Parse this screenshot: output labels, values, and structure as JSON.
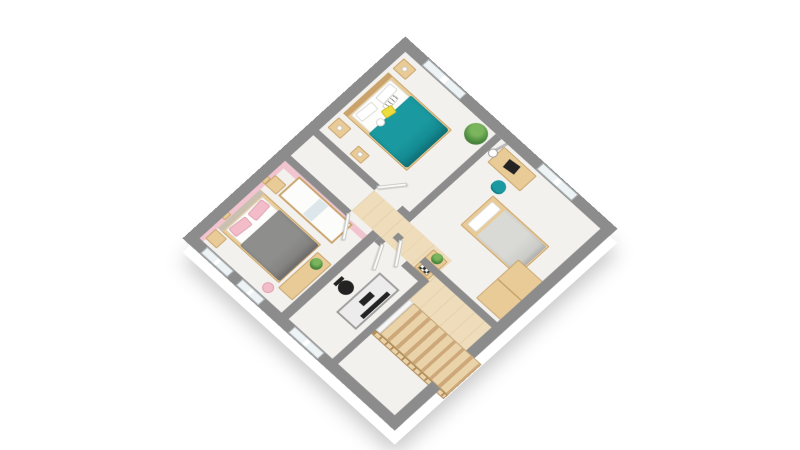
{
  "scene": {
    "kind": "3d-floorplan-render",
    "view": "isometric-top",
    "background": "#ffffff",
    "visible_text": "none"
  },
  "palette": {
    "wall-top": "#8c8c8c",
    "wall-face": "#ffffff",
    "floor": "#f3f1ed",
    "floor-wood": "#eedcba",
    "stair-wood": "#ead3a9",
    "stair-edge": "#cda87a",
    "wood": "#e8cb97",
    "wood-dark": "#c9a36b",
    "teal": "#1a9aa0",
    "teal-dark": "#11828a",
    "yellow": "#ecdc3e",
    "pink-wall": "#f2c4cf",
    "pink": "#f2bcc9",
    "gray-duvet": "#8e8e8c",
    "gray-light": "#d9d9d6",
    "black": "#232323",
    "metal": "#9e9e9e",
    "green": "#4e8c41",
    "green-light": "#7ab45c",
    "mirror": "#dde6ea",
    "door": "#fbfbfa"
  },
  "rooms": [
    {
      "name": "bedroom-top",
      "furniture": [
        "double-bed-teal-duvet",
        "striped-pillow",
        "yellow-pillow",
        "round-cushion",
        "nightstand-with-lamp-left",
        "nightstand-with-lamp-right",
        "side-table-with-lamp",
        "corner-potted-plant"
      ],
      "windows": 1
    },
    {
      "name": "bedroom-right",
      "furniture": [
        "desk-with-laptop",
        "teal-desk-chair",
        "electric-guitar",
        "single-bed-gray-duvet",
        "wood-wardrobe"
      ],
      "windows": 1
    },
    {
      "name": "bedroom-pink",
      "wall_color": "#f2c4cf",
      "furniture": [
        "double-bed-gray-duvet",
        "pink-pillow",
        "pink-pillow",
        "nightstand",
        "nightstand",
        "wall-shelf",
        "wall-shelf",
        "wardrobe-with-mirror",
        "vanity-desk",
        "potted-plant",
        "pink-stool"
      ],
      "windows": 2
    },
    {
      "name": "office",
      "furniture": [
        "metal-frame-desk",
        "black-monitor",
        "black-keyboard",
        "black-office-chair"
      ],
      "windows": 1
    },
    {
      "name": "hallway",
      "floor": "wood",
      "furniture": [
        "console-table",
        "chessboard",
        "potted-plant"
      ],
      "doors": 4
    },
    {
      "name": "staircase",
      "steps": 8,
      "balustrade": "wood",
      "guard_wall": true
    }
  ],
  "openings": {
    "windows_total": 5,
    "doors_total": 4
  }
}
